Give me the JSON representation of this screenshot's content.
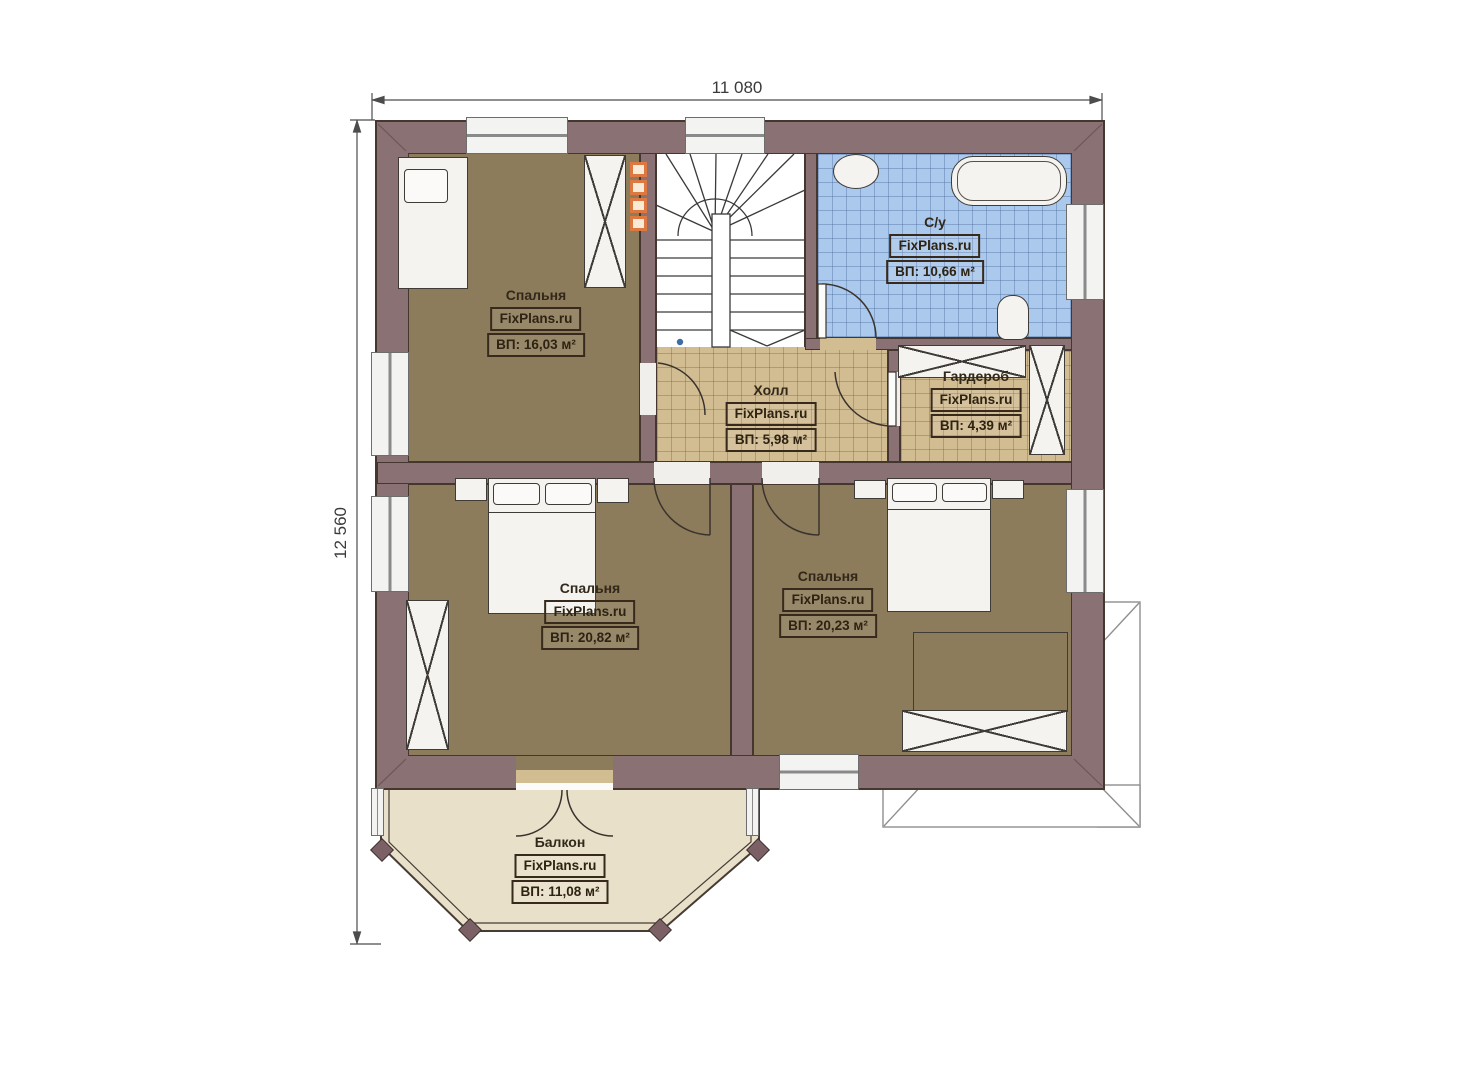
{
  "canvas": {
    "width": 1473,
    "height": 1080,
    "background": "#ffffff"
  },
  "dimensions": {
    "width_label": "11 080",
    "height_label": "12 560"
  },
  "branding": {
    "watermark": "FixPlans.ru"
  },
  "rooms": [
    {
      "id": "bedroom-top-left",
      "name": "Спальня",
      "watermark": "FixPlans.ru",
      "area": "ВП: 16,03 м²"
    },
    {
      "id": "bathroom",
      "name": "С/у",
      "watermark": "FixPlans.ru",
      "area": "ВП: 10,66 м²"
    },
    {
      "id": "hall",
      "name": "Холл",
      "watermark": "FixPlans.ru",
      "area": "ВП: 5,98 м²"
    },
    {
      "id": "wardrobe",
      "name": "Гардероб",
      "watermark": "FixPlans.ru",
      "area": "ВП: 4,39 м²"
    },
    {
      "id": "bedroom-bottom-left",
      "name": "Спальня",
      "watermark": "FixPlans.ru",
      "area": "ВП: 20,82 м²"
    },
    {
      "id": "bedroom-bottom-right",
      "name": "Спальня",
      "watermark": "FixPlans.ru",
      "area": "ВП: 20,23 м²"
    },
    {
      "id": "balcony",
      "name": "Балкон",
      "watermark": "FixPlans.ru",
      "area": "ВП: 11,08 м²"
    }
  ],
  "colors": {
    "wall": "#8a7174",
    "bedroom_floor": "#8d7c5c",
    "hall_floor": "#d2bc92",
    "bathroom_floor": "#abc9ed",
    "balcony_floor": "#e9e0ca",
    "flue_accent": "#dd7840"
  }
}
